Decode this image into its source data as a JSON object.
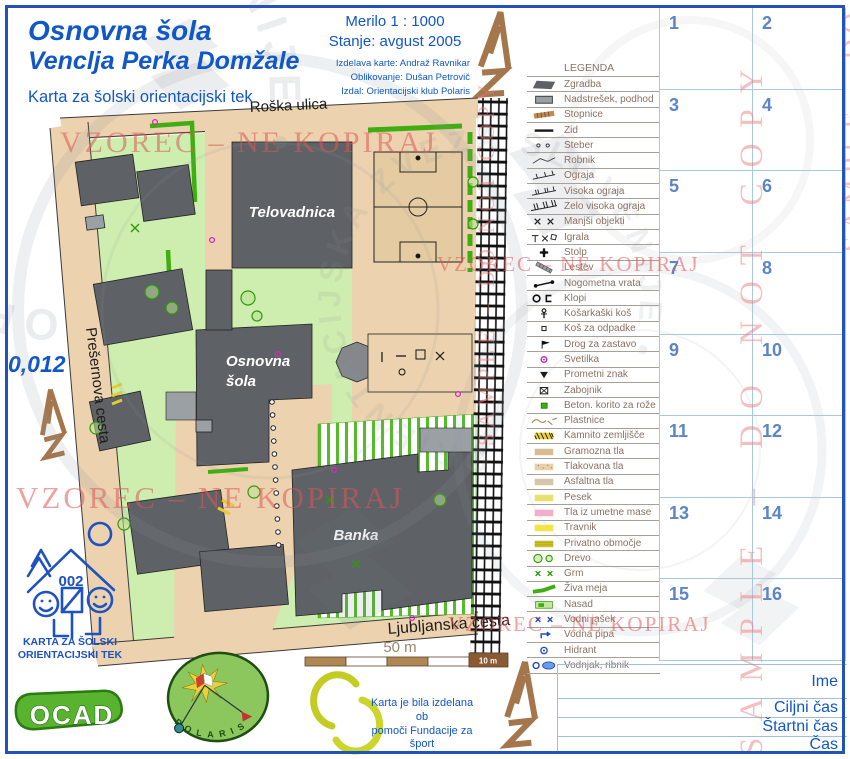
{
  "title": {
    "line1": "Osnovna šola",
    "line2": "Venclja Perka Domžale",
    "subtitle": "Karta za šolski orientacijski tek"
  },
  "info": {
    "scale": "Merilo 1 : 1000",
    "status": "Stanje: avgust 2005",
    "credits": [
      "Izdelava karte: Andraž Ravnikar",
      "Oblikovanje: Dušan Petrovič",
      "Izdal: Orientacijski klub Polaris"
    ]
  },
  "map": {
    "labels": {
      "roska": "Roška ulica",
      "presernova": "Prešernova cesta",
      "ljubljanska": "Ljubljanska cesta",
      "telovadnica": "Telovadnica",
      "school_line1": "Osnovna",
      "school_line2": "šola",
      "banka": "Banka",
      "code": "0,012"
    },
    "scalebar": {
      "total": "50 m",
      "last": "10 m"
    }
  },
  "legend": {
    "heading": "LEGENDA",
    "items": [
      {
        "label": "Zgradba",
        "symbol": "building"
      },
      {
        "label": "Nadstrešek, podhod",
        "symbol": "canopy"
      },
      {
        "label": "Stopnice",
        "symbol": "stairs"
      },
      {
        "label": "Zid",
        "symbol": "wall"
      },
      {
        "label": "Steber",
        "symbol": "pillar"
      },
      {
        "label": "Robnik",
        "symbol": "curb"
      },
      {
        "label": "Ograja",
        "symbol": "fence"
      },
      {
        "label": "Visoka ograja",
        "symbol": "fence-high"
      },
      {
        "label": "Zelo visoka ograja",
        "symbol": "fence-very-high"
      },
      {
        "label": "Manjši objekti",
        "symbol": "small-objects"
      },
      {
        "label": "Igrala",
        "symbol": "playground"
      },
      {
        "label": "Stolp",
        "symbol": "tower"
      },
      {
        "label": "Lestev",
        "symbol": "ladder"
      },
      {
        "label": "Nogometna vrata",
        "symbol": "goal"
      },
      {
        "label": "Klopi",
        "symbol": "benches"
      },
      {
        "label": "Košarkaški koš",
        "symbol": "basketball-hoop"
      },
      {
        "label": "Koš za odpadke",
        "symbol": "waste-bin"
      },
      {
        "label": "Drog za zastavo",
        "symbol": "flagpole"
      },
      {
        "label": "Svetilka",
        "symbol": "lamp"
      },
      {
        "label": "Prometni znak",
        "symbol": "traffic-sign"
      },
      {
        "label": "Zabojnik",
        "symbol": "container"
      },
      {
        "label": "Beton. korito za rože",
        "symbol": "planter"
      },
      {
        "label": "Plastnice",
        "symbol": "contours"
      },
      {
        "label": "Kamnito zemljišče",
        "symbol": "stony-ground"
      },
      {
        "label": "Gramozna tla",
        "symbol": "gravel"
      },
      {
        "label": "Tlakovana tla",
        "symbol": "paving"
      },
      {
        "label": "Asfaltna tla",
        "symbol": "asphalt"
      },
      {
        "label": "Pesek",
        "symbol": "sand"
      },
      {
        "label": "Tla iz umetne mase",
        "symbol": "synthetic"
      },
      {
        "label": "Travnik",
        "symbol": "meadow"
      },
      {
        "label": "Privatno območje",
        "symbol": "private-area"
      },
      {
        "label": "Drevo",
        "symbol": "tree"
      },
      {
        "label": "Grm",
        "symbol": "bush"
      },
      {
        "label": "Živa meja",
        "symbol": "hedge"
      },
      {
        "label": "Nasad",
        "symbol": "plantation"
      },
      {
        "label": "Vodni jašek",
        "symbol": "water-shaft"
      },
      {
        "label": "Vodna pipa",
        "symbol": "water-tap"
      },
      {
        "label": "Hidrant",
        "symbol": "hydrant"
      },
      {
        "label": "Vodnjak, ribnik",
        "symbol": "pond"
      }
    ]
  },
  "control_card": {
    "cells": [
      "1",
      "2",
      "3",
      "4",
      "5",
      "6",
      "7",
      "8",
      "9",
      "10",
      "11",
      "12",
      "13",
      "14",
      "15",
      "16"
    ]
  },
  "form": {
    "rows": [
      "Ime",
      "Ciljni čas",
      "Štartni čas",
      "Čas"
    ]
  },
  "footer": {
    "emblem_number": "002",
    "caption_line1": "KARTA ZA ŠOLSKI",
    "caption_line2": "ORIENTACIJSKI TEK",
    "ocad_label": "OCAD",
    "polaris_letters": "POLARIS",
    "funding_line1": "Karta je bila izdelana ob",
    "funding_line2": "pomoči Fundacije za šport"
  },
  "watermarks": {
    "vzorec": "VZOREC – NE KOPIRAJ",
    "sample": "SAMPLE – DO NOT COPY",
    "stamp": "ORIENTACIJSKA ZVEZA SLOVENIJE •"
  },
  "colors": {
    "title_blue": "#1057c8",
    "grid_blue": "#5b85c8",
    "frame_blue": "#2253b8",
    "watermark_red": "#de5555",
    "road_tan": "#ecd2ae",
    "grass_green": "#cdeeae",
    "building_gray": "#5e6266",
    "canopy_gray": "#9aa0a4",
    "hedge_green": "#3fae12",
    "water_blue": "#2348c8",
    "north_brown": "#a5764c"
  }
}
